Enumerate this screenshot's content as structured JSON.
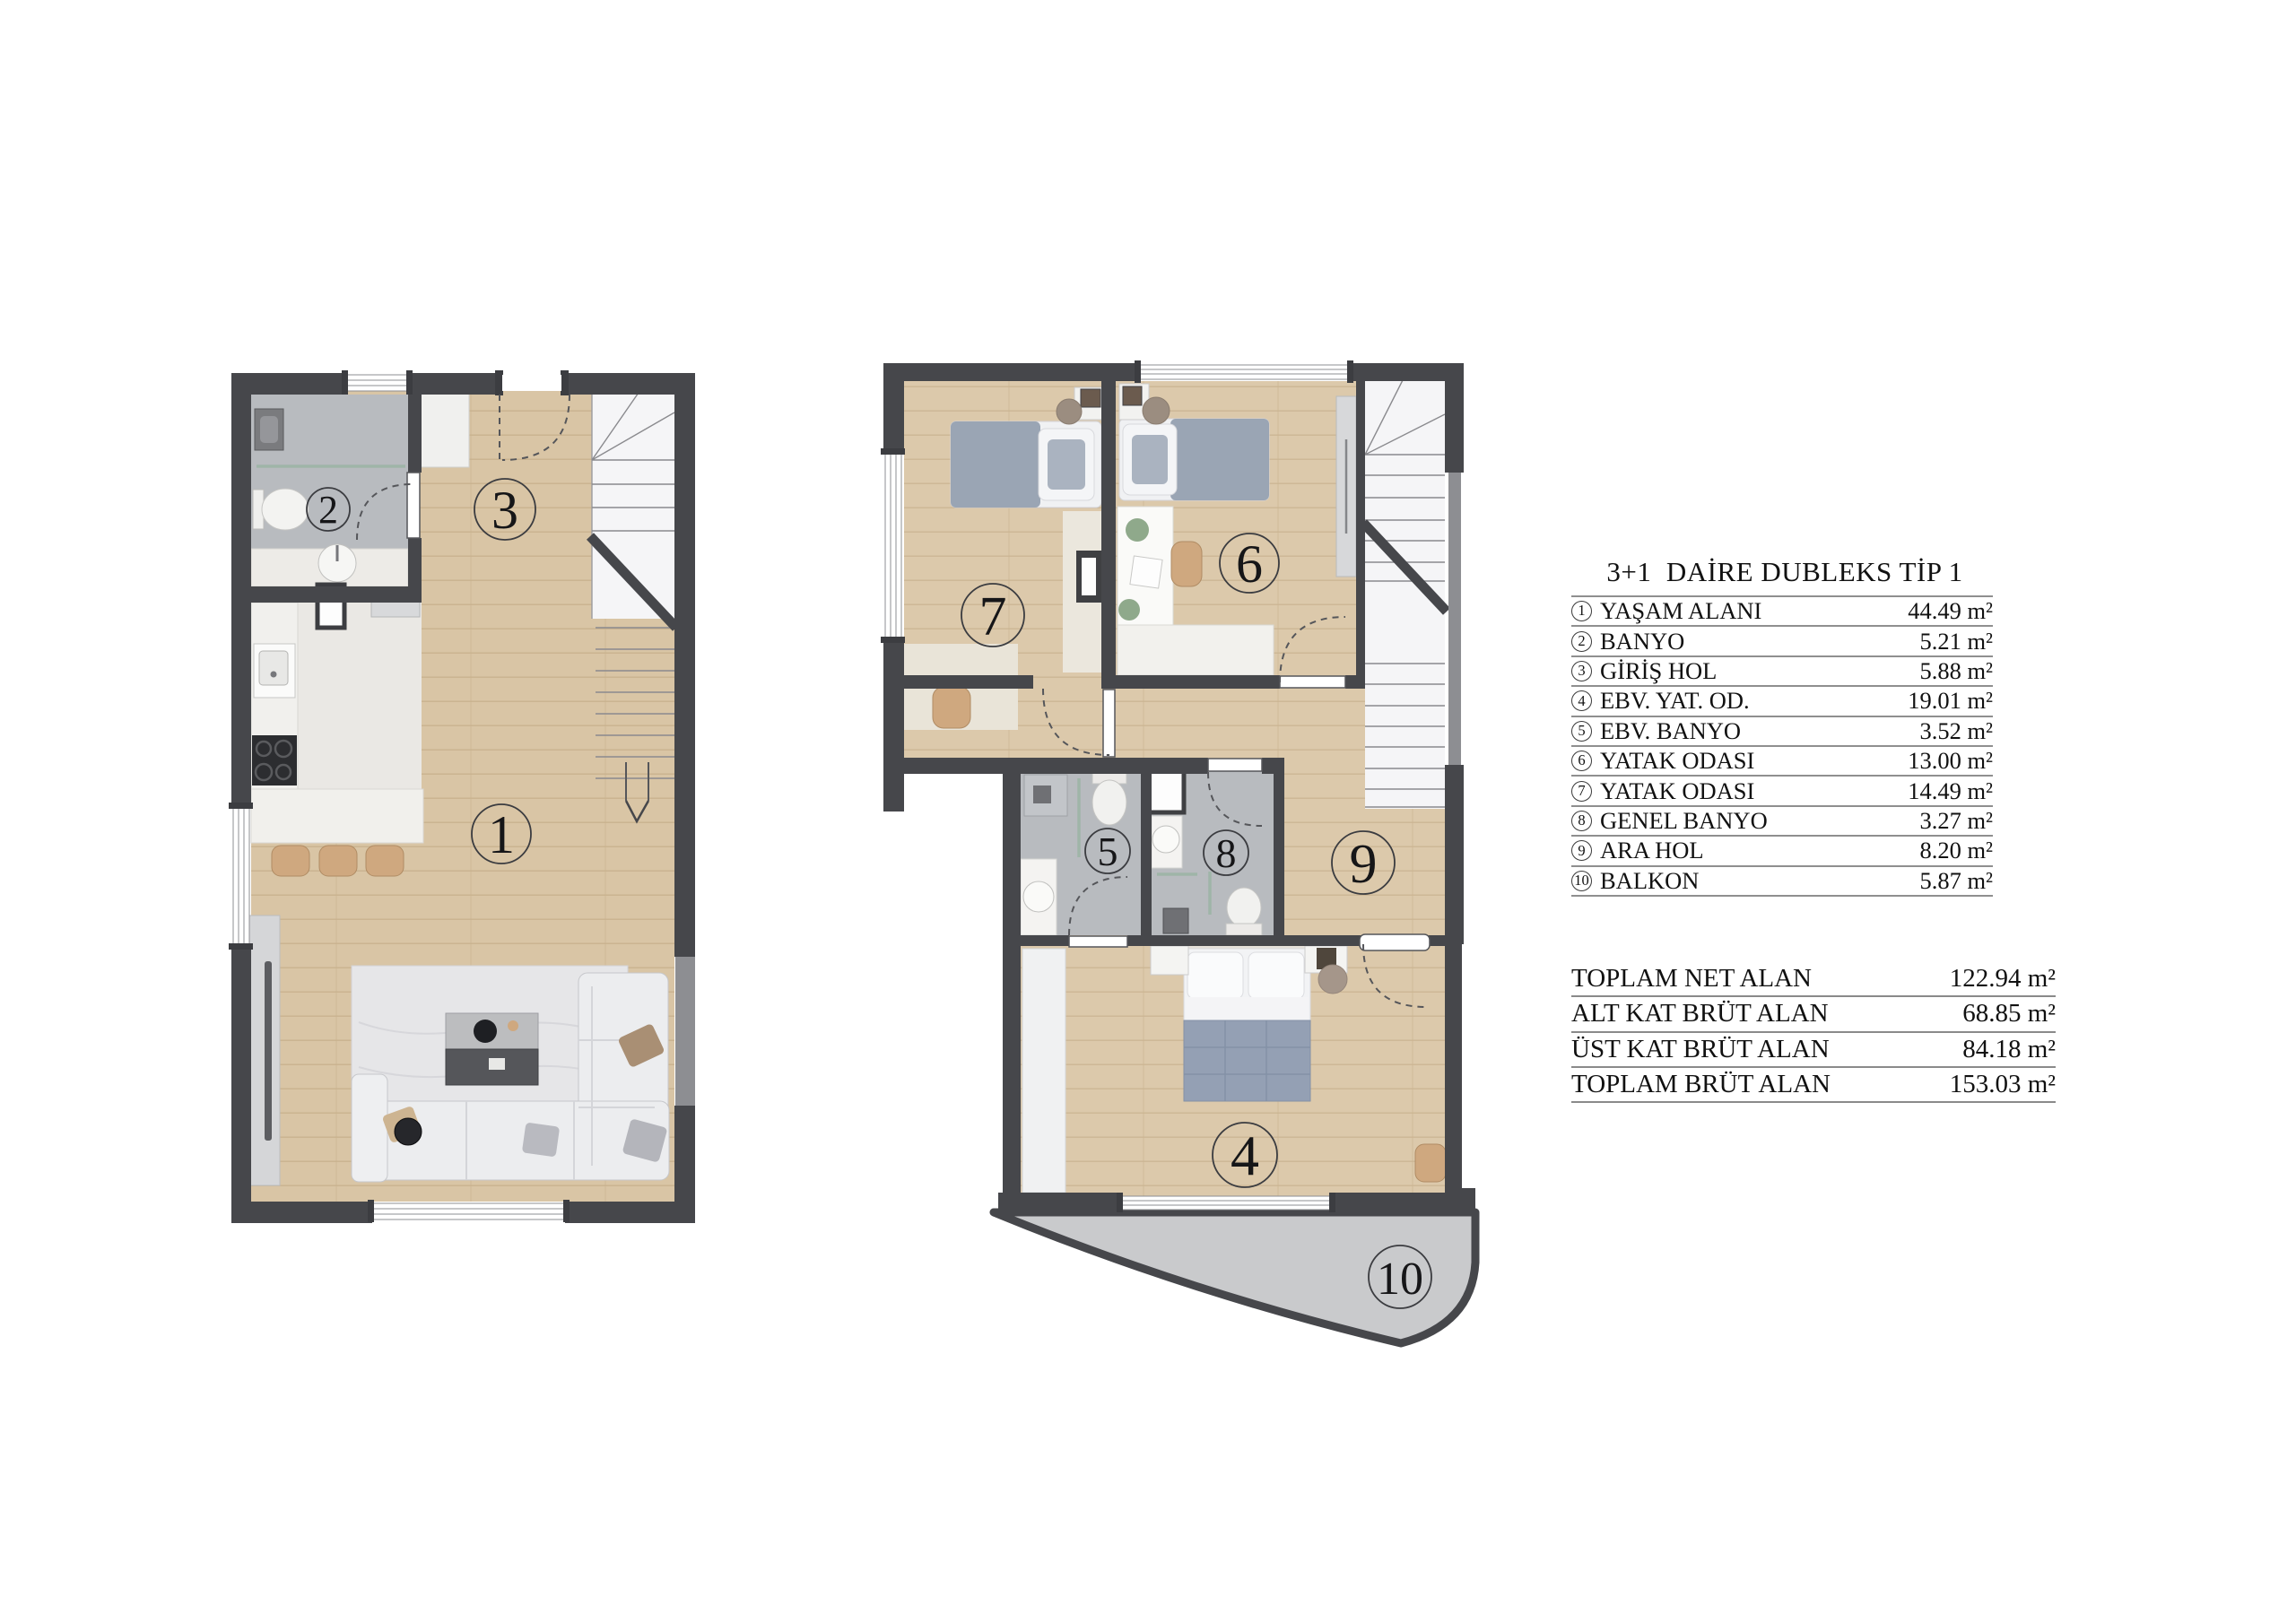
{
  "legend": {
    "title": "3+1  DAİRE DUBLEKS TİP 1",
    "items": [
      {
        "no": "1",
        "label": "YAŞAM ALANI",
        "value": "44.49 m²"
      },
      {
        "no": "2",
        "label": "BANYO",
        "value": "5.21 m²"
      },
      {
        "no": "3",
        "label": "GİRİŞ HOL",
        "value": "5.88 m²"
      },
      {
        "no": "4",
        "label": "EBV. YAT. OD.",
        "value": "19.01 m²"
      },
      {
        "no": "5",
        "label": "EBV. BANYO",
        "value": "3.52 m²"
      },
      {
        "no": "6",
        "label": "YATAK ODASI",
        "value": "13.00 m²"
      },
      {
        "no": "7",
        "label": "YATAK ODASI",
        "value": "14.49 m²"
      },
      {
        "no": "8",
        "label": "GENEL BANYO",
        "value": "3.27 m²"
      },
      {
        "no": "9",
        "label": "ARA HOL",
        "value": "8.20 m²"
      },
      {
        "no": "10",
        "label": "BALKON",
        "value": "5.87 m²"
      }
    ],
    "totals": [
      {
        "label": "TOPLAM NET ALAN",
        "value": "122.94 m²"
      },
      {
        "label": "ALT KAT BRÜT ALAN",
        "value": "68.85 m²"
      },
      {
        "label": "ÜST KAT BRÜT ALAN",
        "value": "84.18 m²"
      },
      {
        "label": "TOPLAM BRÜT ALAN",
        "value": "153.03 m²"
      }
    ]
  },
  "colors": {
    "wall": "#46474b",
    "wood": "#d9c5a5",
    "tile": "#b8bbbf",
    "marble": "#f5f5f7",
    "kitchen_floor": "#eae8e4",
    "rug": "#e6e6e8",
    "balcony": "#c9cacc",
    "accent_tan": "#cfa87f"
  }
}
